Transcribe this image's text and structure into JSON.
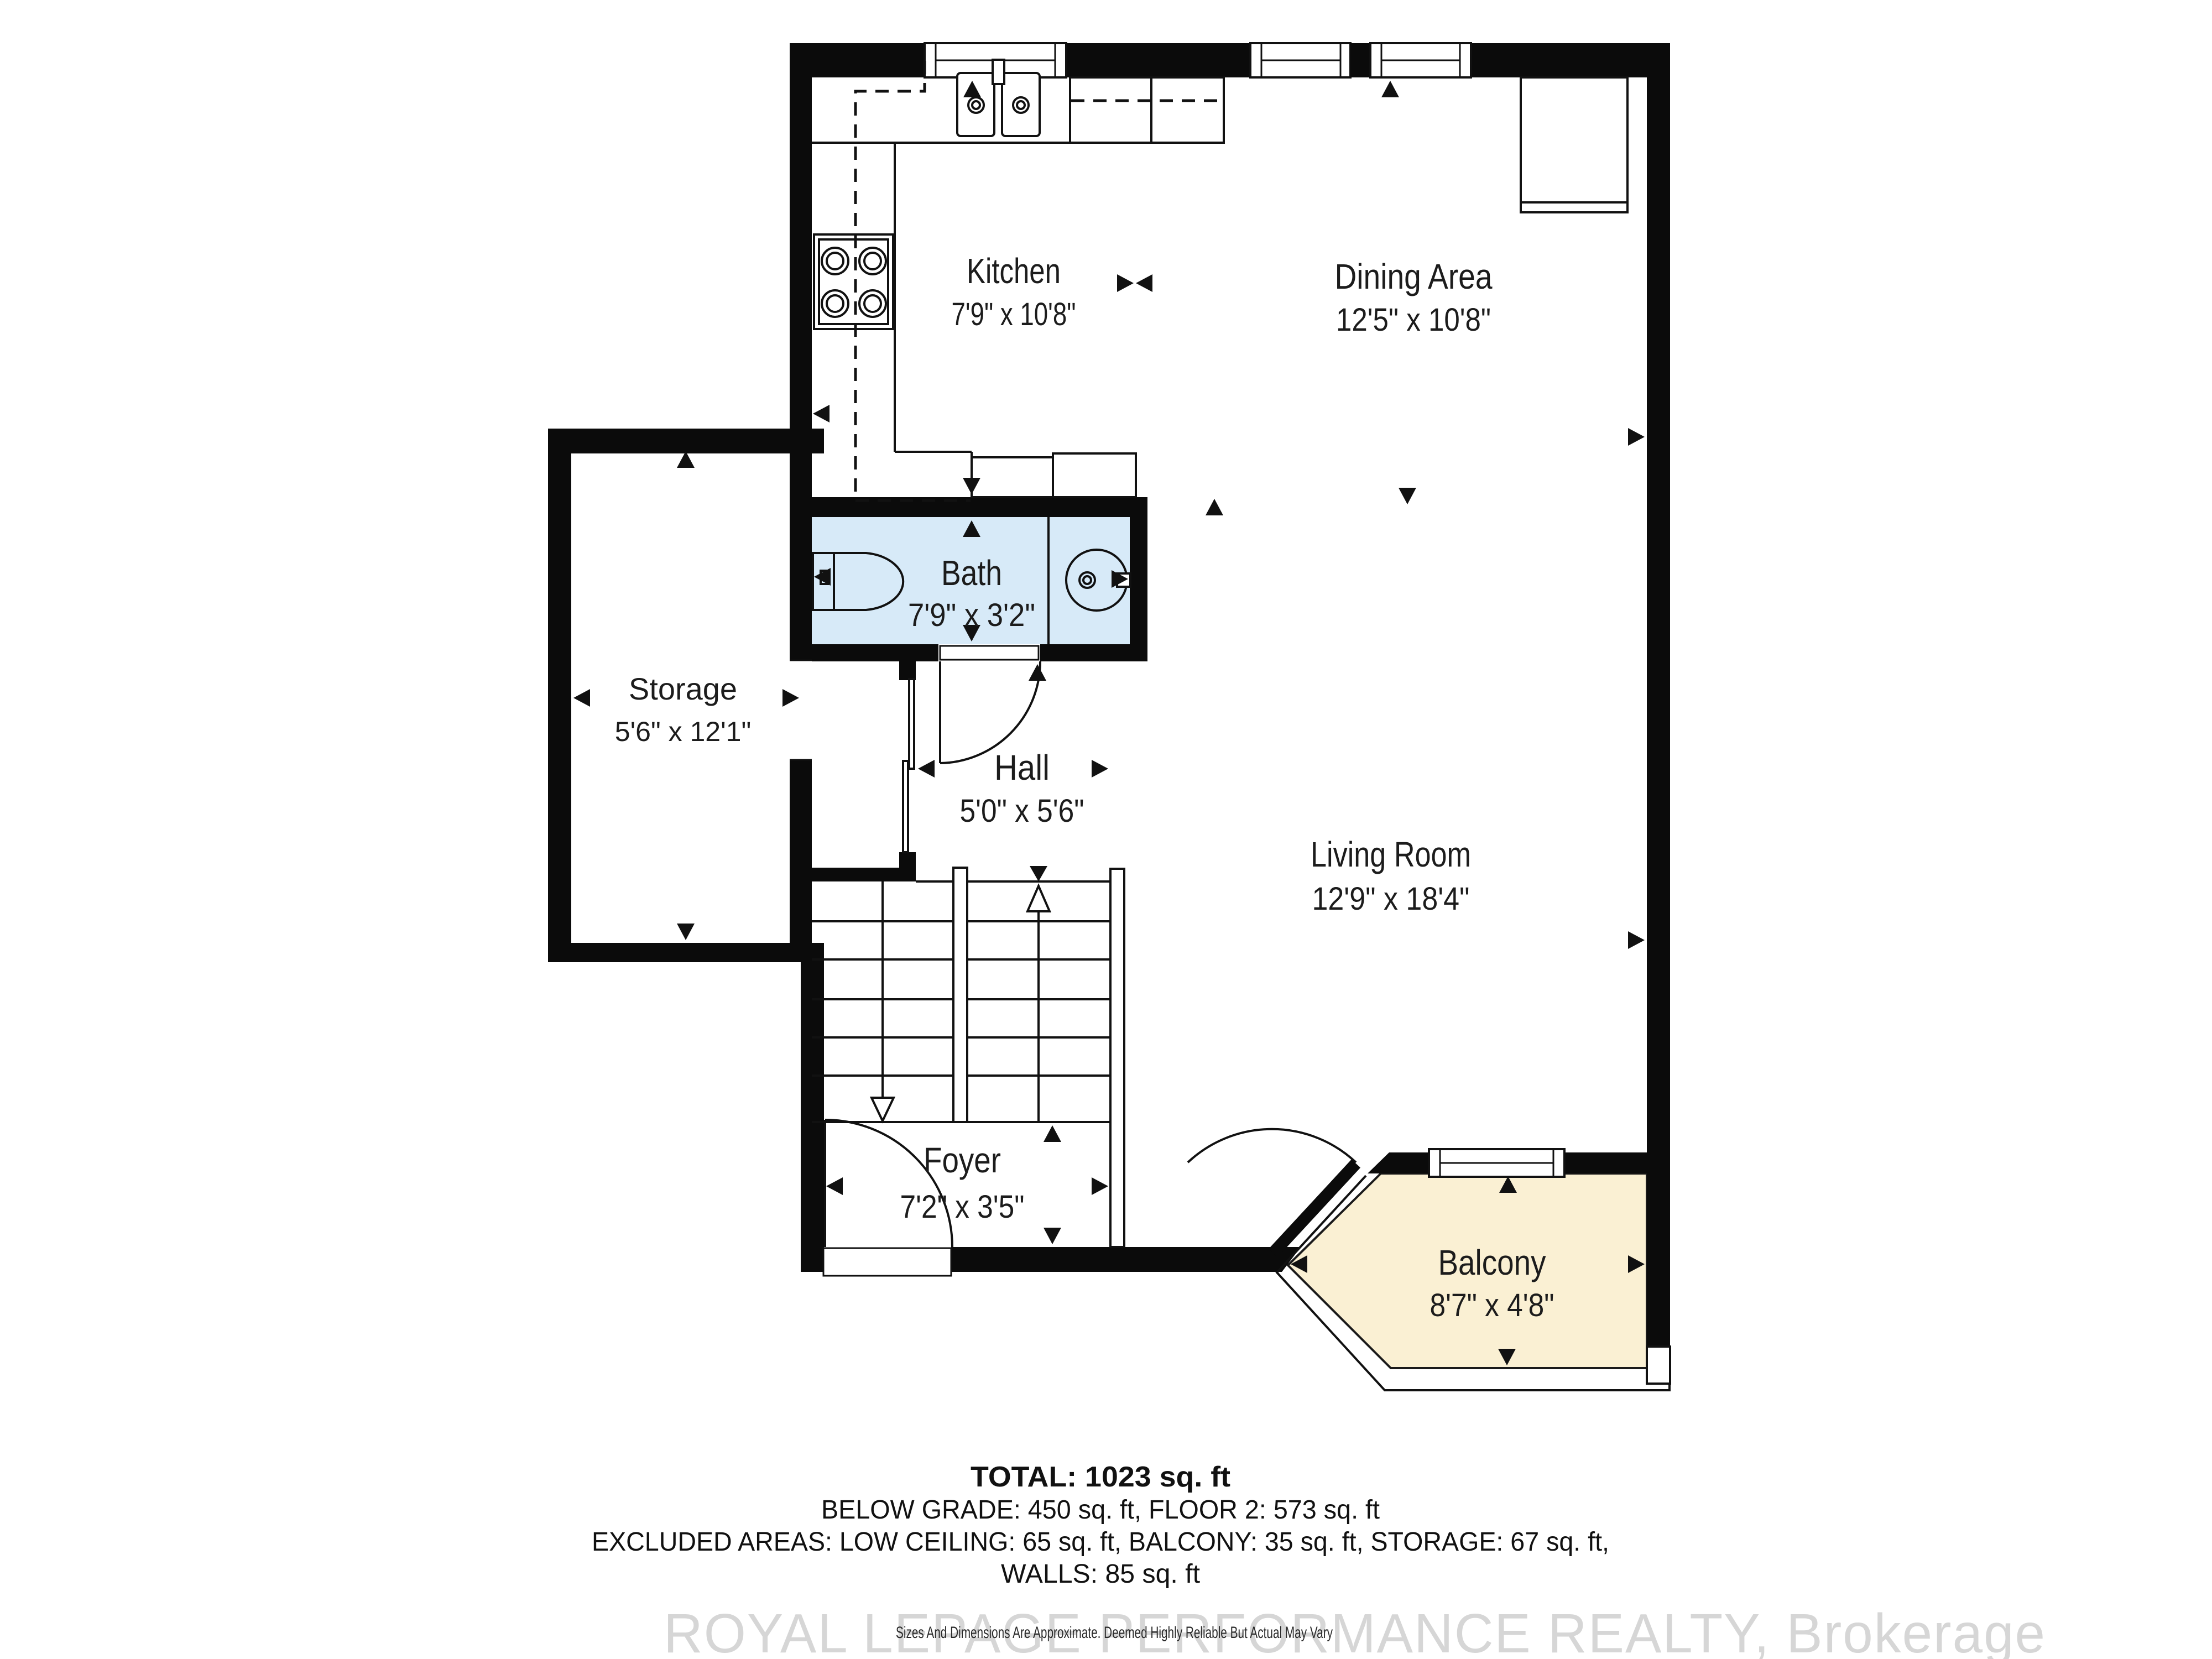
{
  "colors": {
    "wall": "#0b0b0b",
    "bath_fill": "#d7eaf8",
    "balcony_fill": "#faf0d3",
    "label": "#1c1c1c",
    "watermark": "#d6d6d6"
  },
  "rooms": {
    "kitchen": {
      "name": "Kitchen",
      "dims": "7'9\" x 10'8\""
    },
    "dining": {
      "name": "Dining Area",
      "dims": "12'5\" x 10'8\""
    },
    "bath": {
      "name": "Bath",
      "dims": "7'9\" x 3'2\""
    },
    "storage": {
      "name": "Storage",
      "dims": "5'6\" x 12'1\""
    },
    "hall": {
      "name": "Hall",
      "dims": "5'0\" x 5'6\""
    },
    "living": {
      "name": "Living Room",
      "dims": "12'9\" x 18'4\""
    },
    "foyer": {
      "name": "Foyer",
      "dims": "7'2\" x 3'5\""
    },
    "balcony": {
      "name": "Balcony",
      "dims": "8'7\" x 4'8\""
    }
  },
  "summary": {
    "total": "TOTAL: 1023 sq. ft",
    "line2": "BELOW GRADE: 450 sq. ft, FLOOR 2: 573 sq. ft",
    "line3": "EXCLUDED AREAS: LOW CEILING: 65 sq. ft, BALCONY: 35 sq. ft, STORAGE: 67 sq. ft,",
    "line4": "WALLS: 85 sq. ft"
  },
  "footer": {
    "watermark": "ROYAL LEPAGE PERFORMANCE REALTY, Brokerage",
    "disclaimer": "Sizes And Dimensions Are Approximate. Deemed Highly Reliable But Actual May Vary"
  }
}
